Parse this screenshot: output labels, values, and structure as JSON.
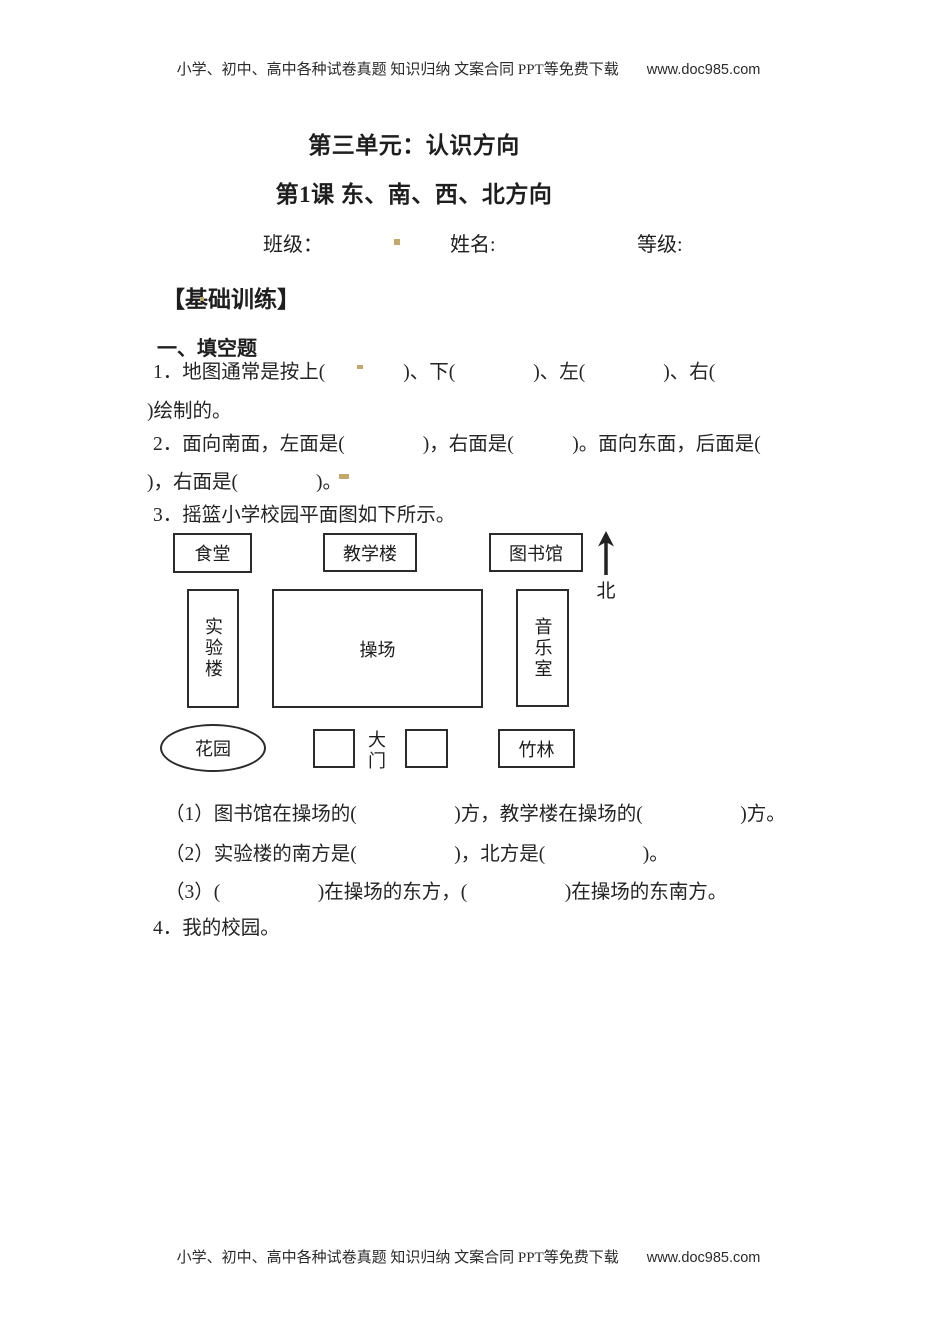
{
  "header": {
    "promo": "小学、初中、高中各种试卷真题 知识归纳 文案合同 PPT等免费下载",
    "url": "www.doc985.com"
  },
  "footer": {
    "promo": "小学、初中、高中各种试卷真题 知识归纳 文案合同 PPT等免费下载",
    "url": "www.doc985.com"
  },
  "titles": {
    "unit": "第三单元：认识方向",
    "lesson": "第1课 东、南、西、北方向"
  },
  "student_info": {
    "class_label": "班级：",
    "name_label": "姓名:",
    "grade_label": "等级:"
  },
  "sections": {
    "basic_training": "【基础训练】",
    "fill_in_blank": "一、填空题"
  },
  "questions": {
    "q1": {
      "line1": "1．地图通常是按上(　　　　)、下(　　　　)、左(　　　　)、右(",
      "line2": ")绘制的。"
    },
    "q2": {
      "line1": "2．面向南面，左面是(　　　　)，右面是(　　　)。面向东面，后面是(",
      "line2": ")，右面是(　　　　)。"
    },
    "q3": {
      "intro": "3．摇篮小学校园平面图如下所示。",
      "sub1": "（1）图书馆在操场的(　　　　　)方，教学楼在操场的(　　　　　)方。",
      "sub2": "（2）实验楼的南方是(　　　　　)，北方是(　　　　　)。",
      "sub3": "（3）(　　　　　)在操场的东方，(　　　　　)在操场的东南方。"
    },
    "q4": "4．我的校园。"
  },
  "campus_map": {
    "canteen": "食堂",
    "teaching_building": "教学楼",
    "library": "图书馆",
    "north_label": "北",
    "lab_building": "实验楼",
    "playground": "操场",
    "music_room": "音乐室",
    "garden": "花园",
    "gate": "大门",
    "bamboo_grove": "竹林"
  },
  "colors": {
    "background": "#ffffff",
    "text": "#1e1e1e",
    "map_border": "#2b2b2b",
    "highlight_mark": "#c2a86b"
  }
}
